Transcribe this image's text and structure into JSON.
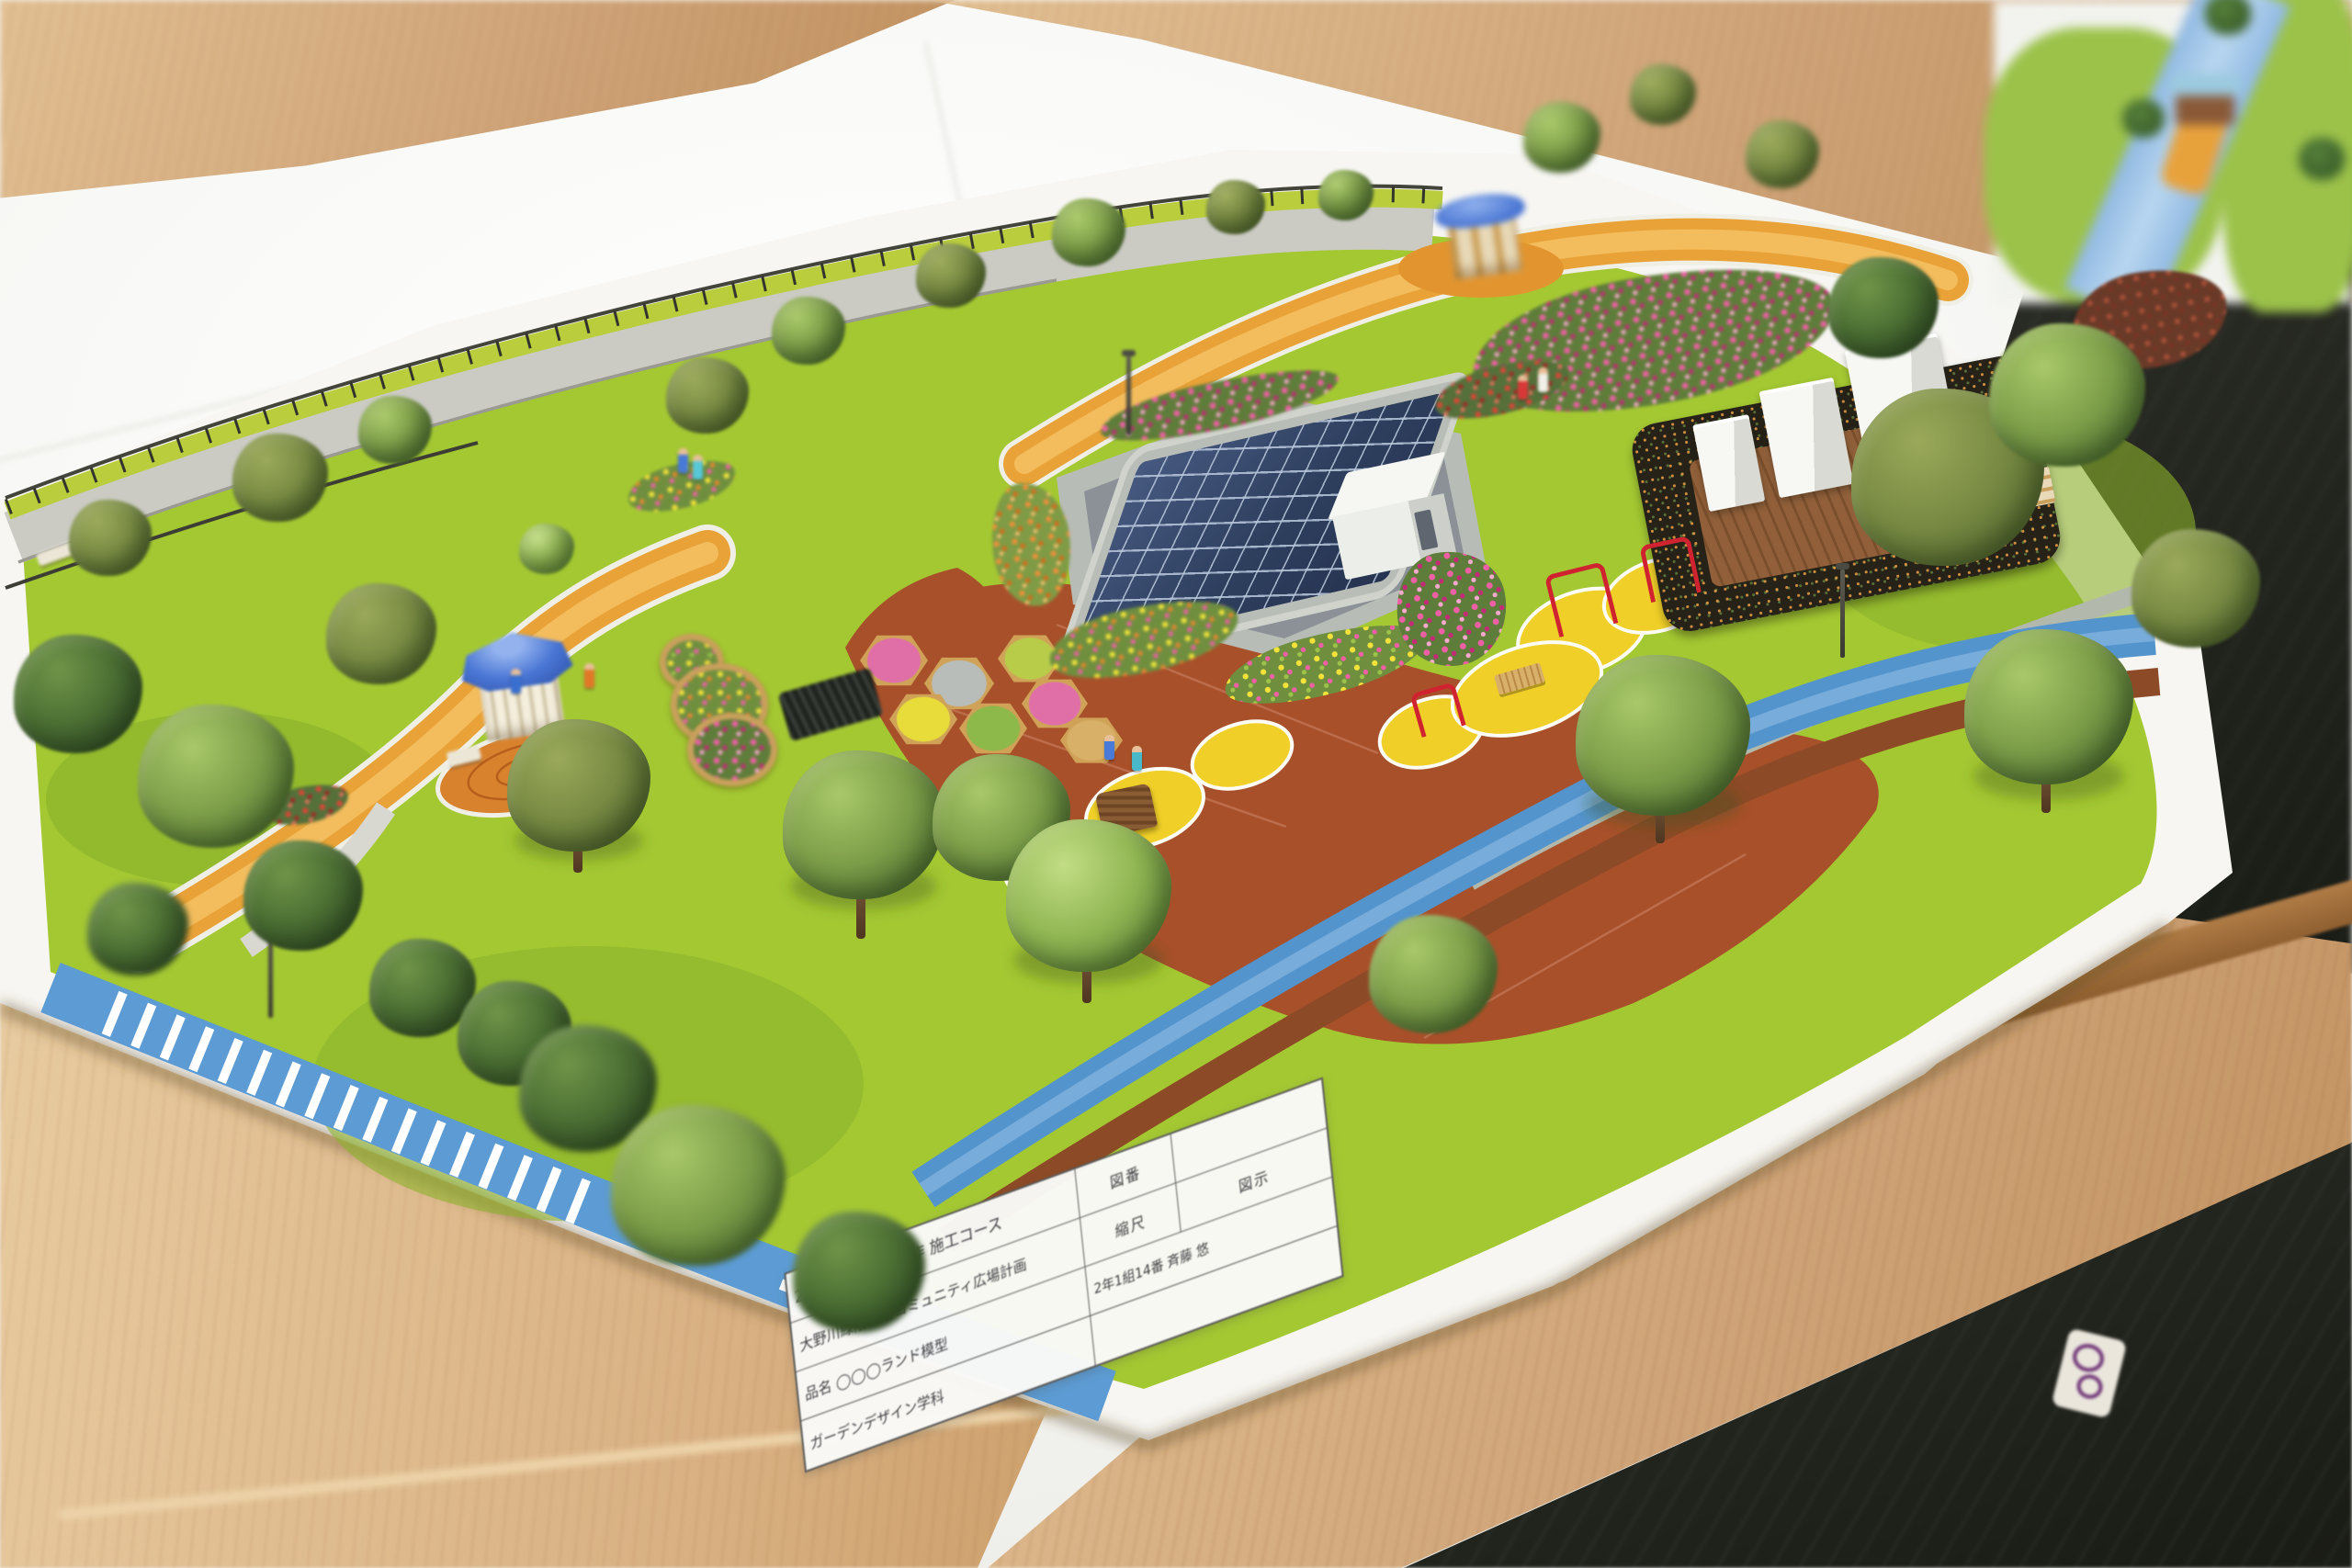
{
  "photo": {
    "subject_kind": "architectural-landscape-model-photo"
  },
  "title_block": {
    "row1_left": "2021年度 卒業制作 施工コース",
    "row1_mid_label": "図番",
    "row2_left": "大野川緑陰道路コミュニティ広場計画",
    "row2_mid_label": "縮尺",
    "row2_right_label": "図示",
    "row3_left_label": "品名",
    "row3_left_value": "◯◯◯ランド模型",
    "row3_right": "2年1組14番 斉藤 悠",
    "row4_left": "ガーデンデザイン学科"
  },
  "palette": {
    "base_board": "#f7f6f2",
    "lawn_green": "#a4c832",
    "path_orange": "#e8a237",
    "stream_blue": "#5494cc",
    "road_blue": "#5c9bd3",
    "plaza_red": "#a8502a",
    "gazebo_roof_blue": "#4a76d4",
    "solar_panel_blue": "#33415e",
    "table_wood": "#cfa478",
    "floor_dark": "#24261f",
    "flower_pink": "#ee5fa5",
    "flower_yellow": "#f2e23a",
    "pad_yellow": "#f0d028"
  }
}
